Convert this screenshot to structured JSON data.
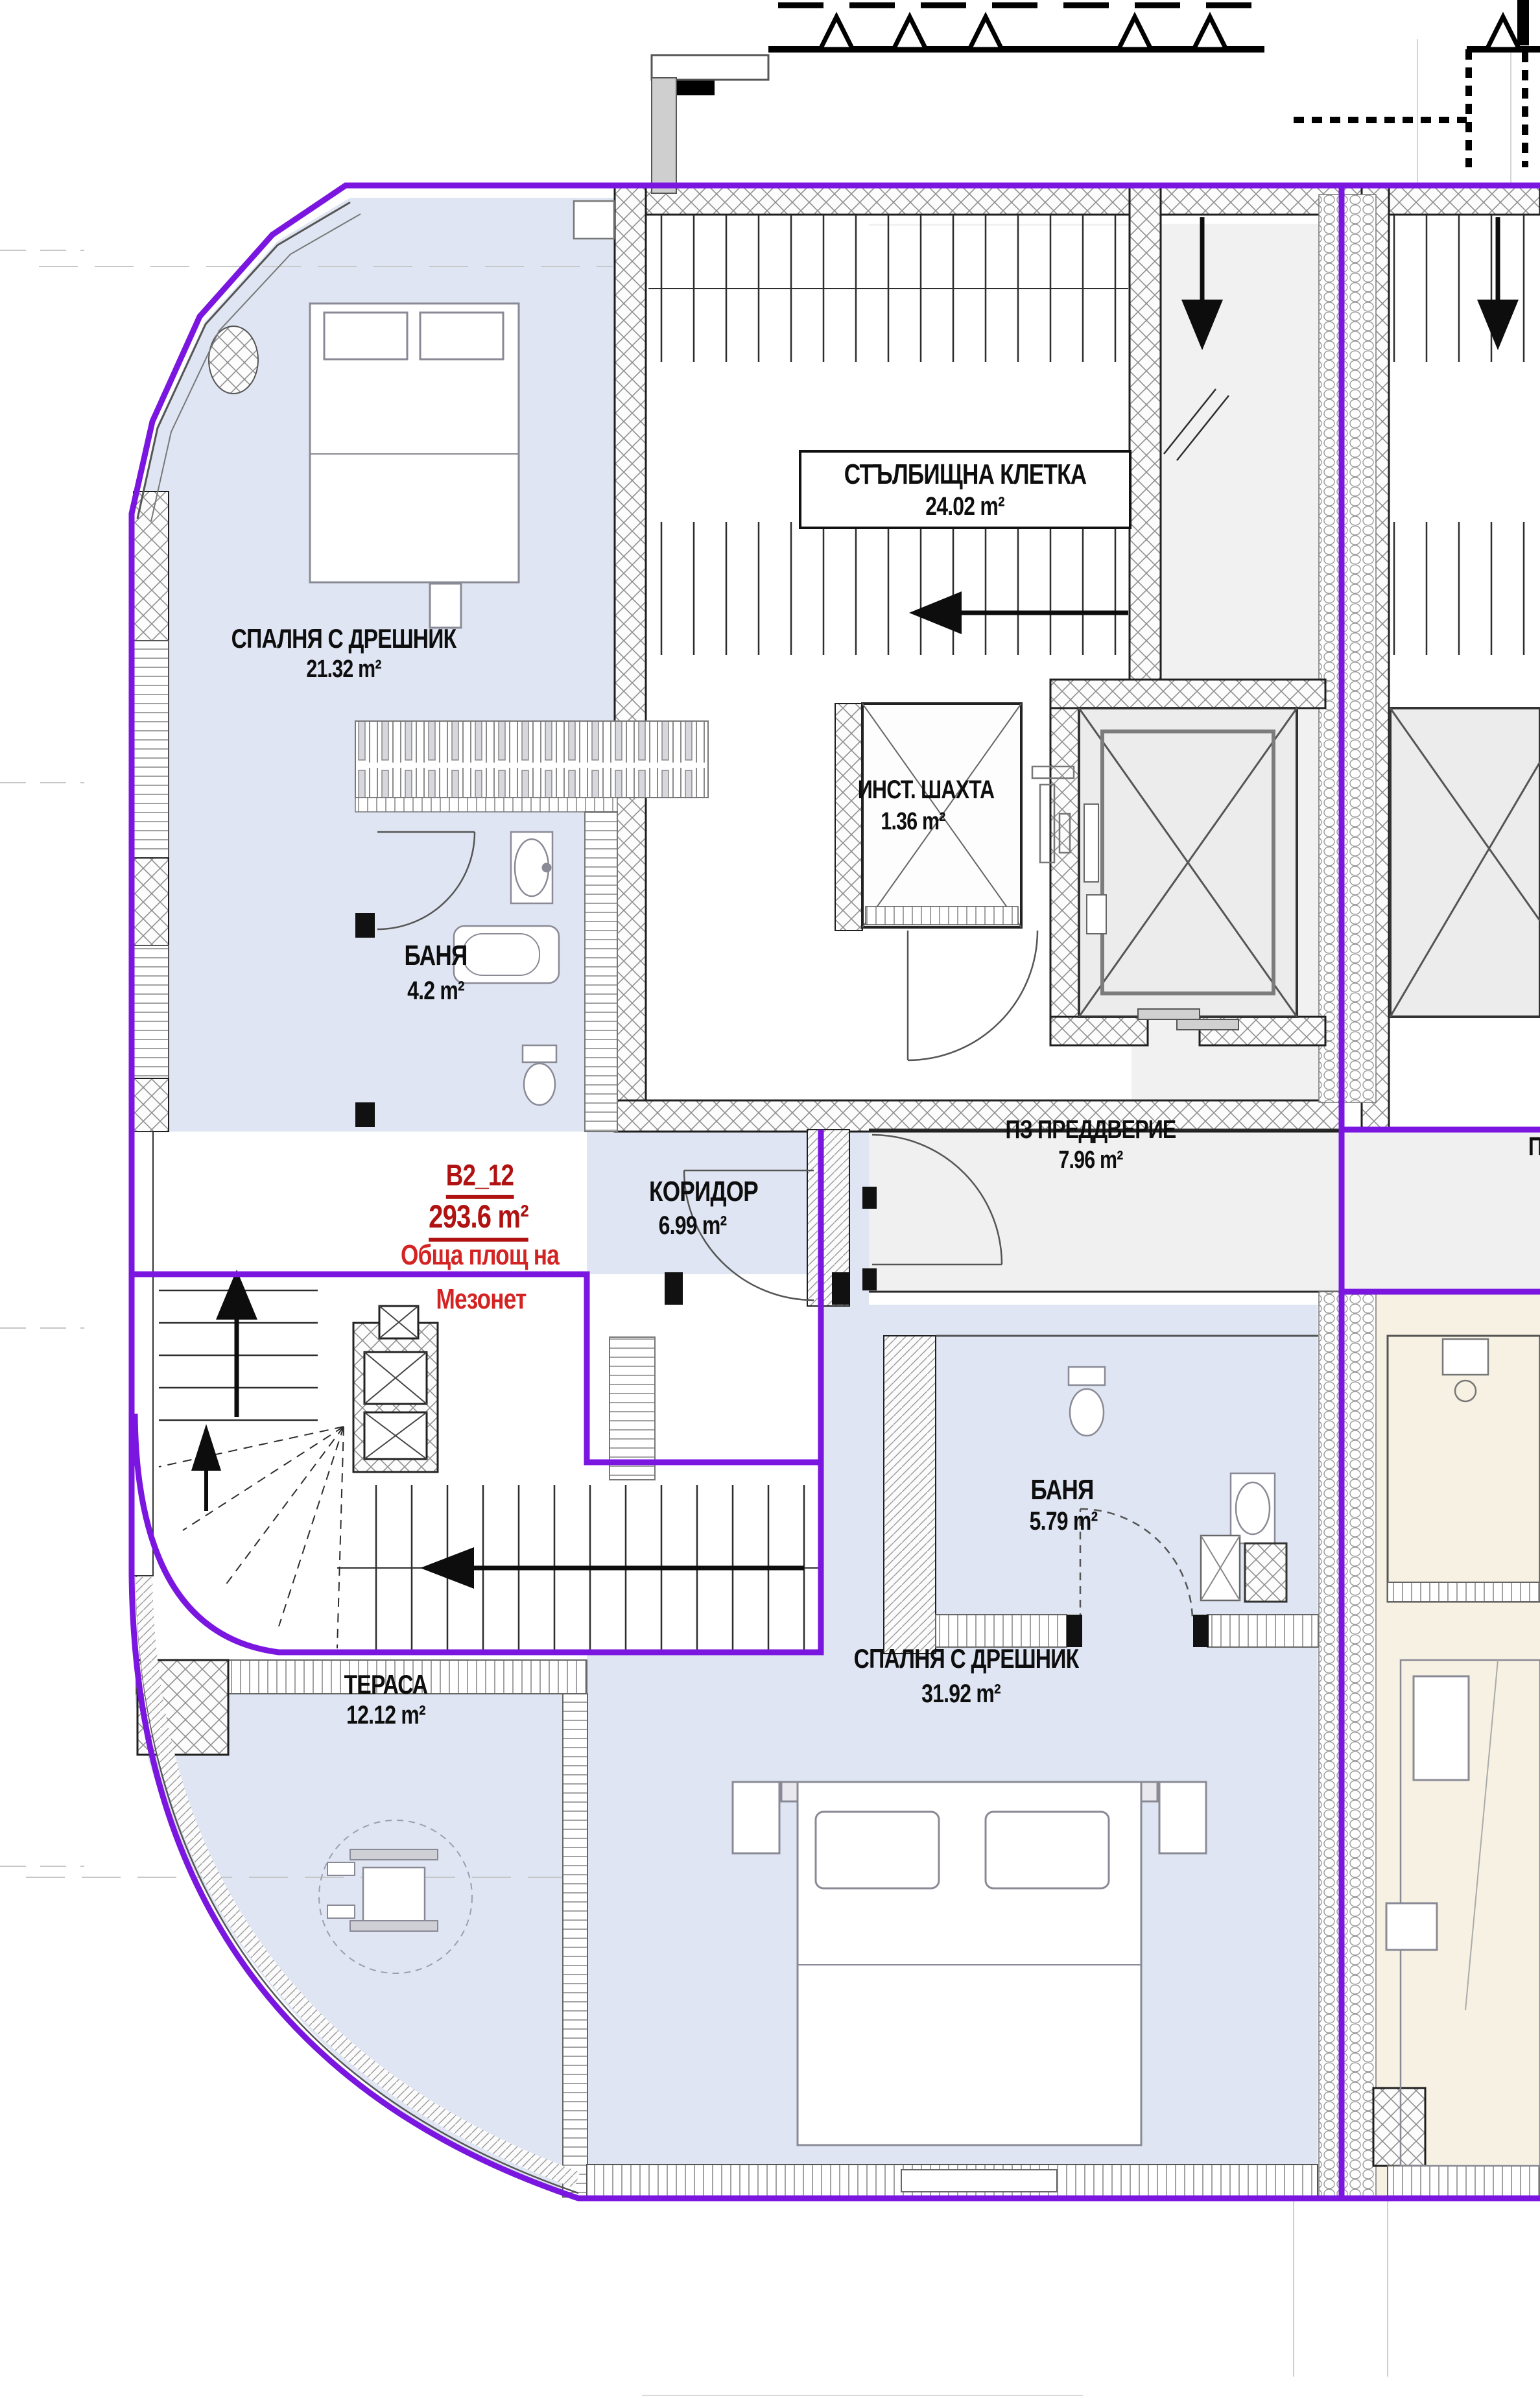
{
  "drawing": {
    "type": "architectural-floor-plan",
    "language": "Bulgarian"
  },
  "unit": {
    "code": "B2_12",
    "total_area": "293.6 m²",
    "note_line1": "Обща площ на",
    "note_line2": "Мезонет"
  },
  "rooms": [
    {
      "name": "СПАЛНЯ С ДРЕШНИК",
      "area": "21.32 m²"
    },
    {
      "name": "СТЪЛБИЩНА КЛЕТКА",
      "area": "24.02 m²"
    },
    {
      "name": "ИНСТ. ШАХТА",
      "area": "1.36 m²"
    },
    {
      "name": "БАНЯ",
      "area": "4.2 m²"
    },
    {
      "name": "ПЗ ПРЕДДВЕРИЕ",
      "area": "7.96 m²"
    },
    {
      "name": "КОРИДОР",
      "area": "6.99 m²"
    },
    {
      "name": "БАНЯ",
      "area": "5.79 m²"
    },
    {
      "name": "СПАЛНЯ С ДРЕШНИК",
      "area": "31.92 m²"
    },
    {
      "name": "ТЕРАСА",
      "area": "12.12 m²"
    }
  ],
  "partial_labels": {
    "right_edge": "П"
  },
  "colors": {
    "boundary_purple": "#7a16e0",
    "room_fill_blue": "#dfe5f2",
    "common_fill_gray": "#f0f0f0",
    "neighbor_fill_cream": "#f6f1e2",
    "unit_code_red": "#b01212",
    "note_red": "#d42323"
  }
}
